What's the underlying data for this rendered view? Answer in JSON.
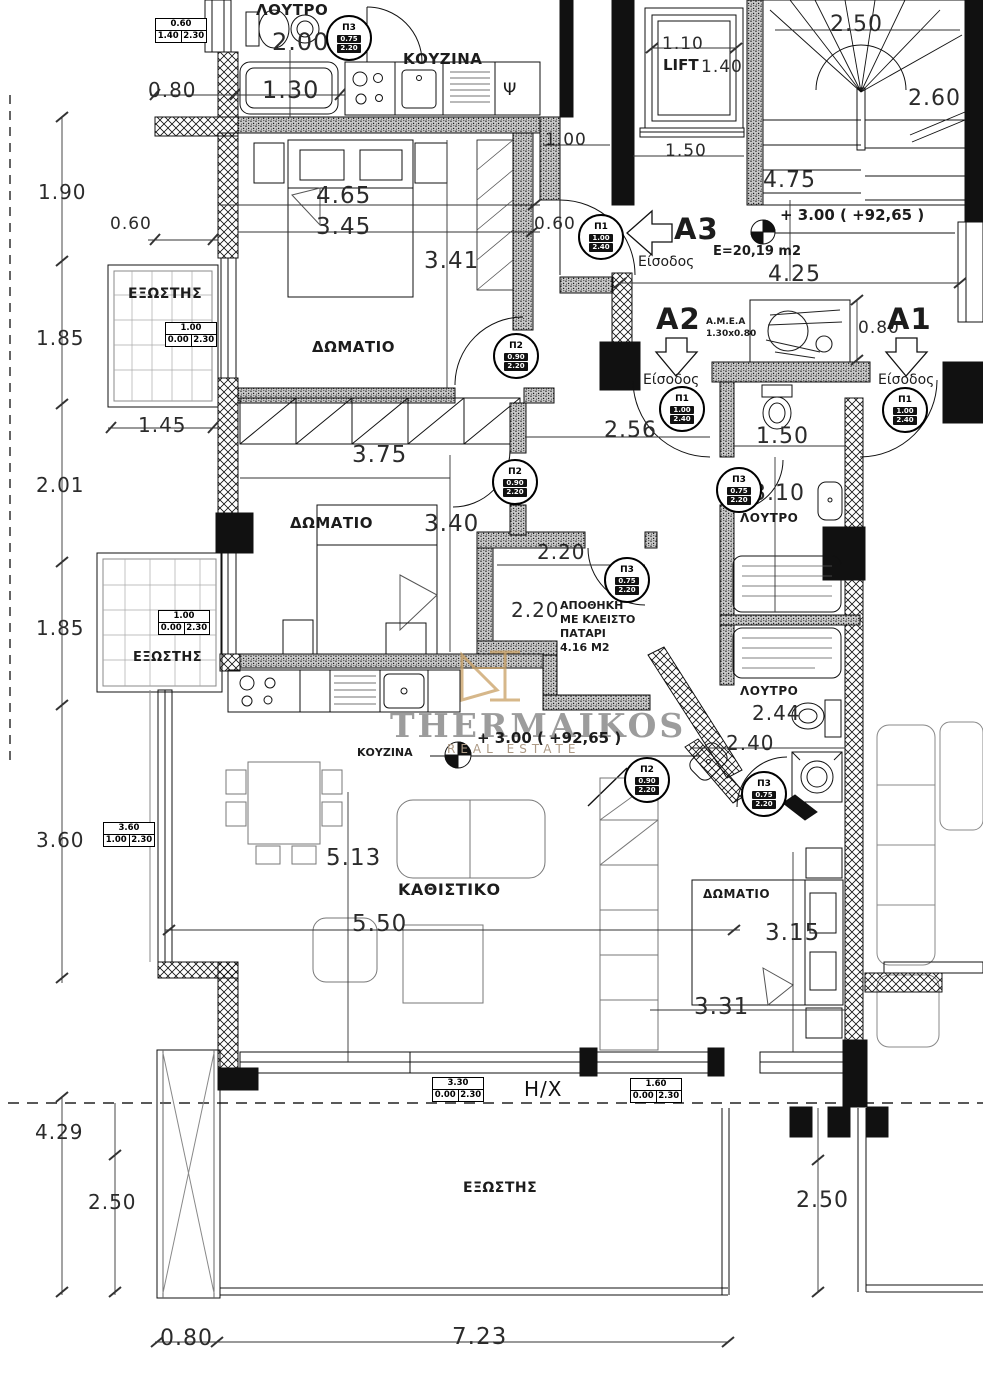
{
  "watermark": {
    "name": "THERMAIKOS",
    "tagline": "REAL ESTATE"
  },
  "apartments": {
    "a1": {
      "label": "A1",
      "entrance": "Είσοδος"
    },
    "a2": {
      "label": "A2",
      "entrance": "Είσοδος",
      "amea": "Α.Μ.Ε.Α",
      "amea_size": "1.30x0.80"
    },
    "a3": {
      "label": "A3",
      "entrance": "Είσοδος",
      "area": "E=20,19 m2"
    }
  },
  "levels": {
    "hall": "+ 3.00 ( +92,65 )",
    "kitchen": "+ 3.00 ( +92,65 )"
  },
  "rooms": {
    "bath_top": "ΛΟΥΤΡΟ",
    "kitchen_top": "ΚΟΥΖΙΝΑ",
    "bedroom": "ΔΩΜΑΤΙΟ",
    "living": "ΚΑΘΙΣΤΙΚΟ",
    "bath": "ΛΟΥΤΡΟ",
    "balcony": "ΕΞΩΣΤΗΣ",
    "kitchen": "ΚΟΥΖΙΝΑ",
    "lift": "LIFT",
    "hx": "Η/Χ",
    "psi": "Ψ",
    "storage_l1": "ΑΠΟΘΗΚΗ",
    "storage_l2": "ΜΕ ΚΛΕΙΣΤΟ",
    "storage_l3": "ΠΑΤΑΡΙ",
    "storage_l4": "4.16 Μ2"
  },
  "door_types": {
    "p1": {
      "code": "Π1",
      "w": "1.00",
      "h": "2.40"
    },
    "p2": {
      "code": "Π2",
      "w": "0.90",
      "h": "2.20"
    },
    "p3": {
      "code": "Π3",
      "w": "0.75",
      "h": "2.20"
    }
  },
  "window_boxes": [
    {
      "w": "0.60",
      "sill": "1.40",
      "top": "2.30"
    },
    {
      "w": "1.00",
      "sill": "0.00",
      "top": "2.30"
    },
    {
      "w": "1.00",
      "sill": "0.00",
      "top": "2.30"
    },
    {
      "w": "3.60",
      "sill": "1.00",
      "top": "2.30"
    },
    {
      "w": "3.30",
      "sill": "0.00",
      "top": "2.30"
    },
    {
      "w": "1.60",
      "sill": "0.00",
      "top": "2.30"
    }
  ],
  "dims": {
    "bath_2_00": "2.00",
    "top_0_80": "0.80",
    "bath_1_30": "1.30",
    "hall_1_00": "1.00",
    "lift_1_10": "1.10",
    "lift_1_40": "1.40",
    "lift_1_50": "1.50",
    "stairs_2_50": "2.50",
    "stairs_2_60": "2.60",
    "stairs_4_75": "4.75",
    "hall_4_25": "4.25",
    "amea_0_80": "0.80",
    "left_1_90": "1.90",
    "left_0_60": "0.60",
    "left_1_85a": "1.85",
    "left_2_01": "2.01",
    "left_1_85b": "1.85",
    "left_3_60": "3.60",
    "left_4_29": "4.29",
    "left_2_50": "2.50",
    "r1_4_65": "4.65",
    "r1_3_45": "3.45",
    "r1_3_41": "3.41",
    "r1_0_60": "0.60",
    "balc_1_45": "1.45",
    "r2_3_75": "3.75",
    "r2_3_40": "3.40",
    "hall_2_56": "2.56",
    "bath_1_50": "1.50",
    "bath_3_10": "3.10",
    "st_2_20a": "2.20",
    "st_2_20b": "2.20",
    "bath2_2_44": "2.44",
    "bath2_2_40": "2.40",
    "liv_5_13": "5.13",
    "liv_5_50": "5.50",
    "br_3_15": "3.15",
    "br_3_31": "3.31",
    "bot_2_50r": "2.50",
    "bot_0_80": "0.80",
    "bot_7_23": "7.23"
  }
}
